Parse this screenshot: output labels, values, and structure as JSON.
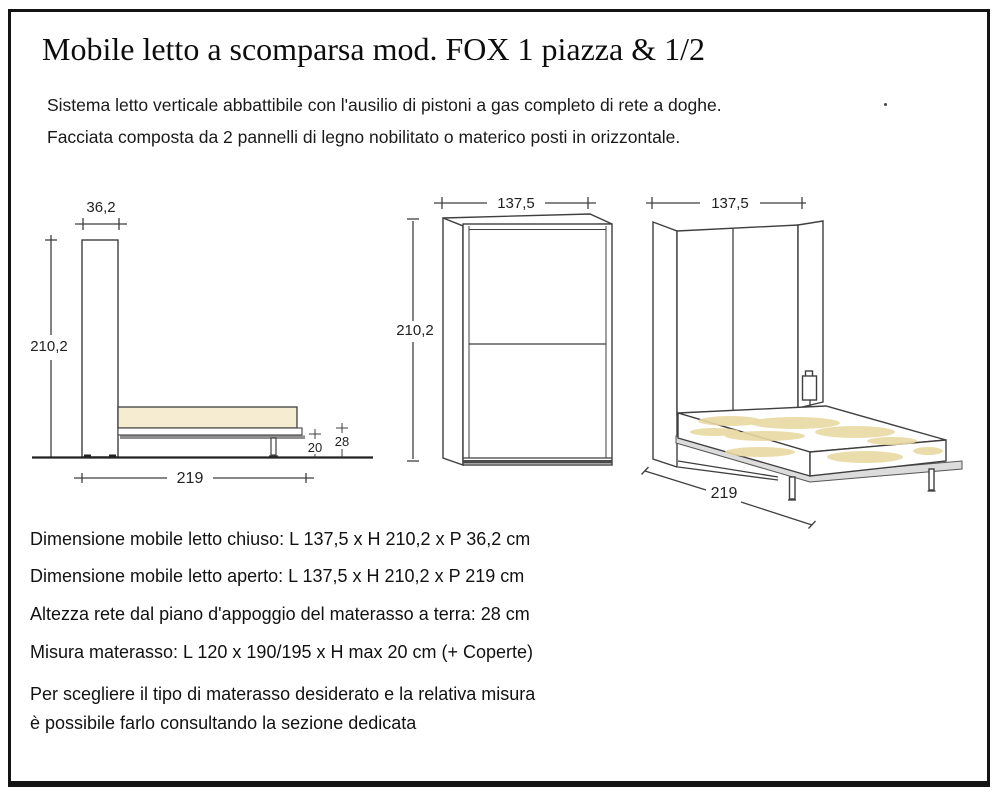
{
  "header": {
    "title": "Mobile letto a scomparsa mod. FOX 1 piazza & 1/2",
    "description_line1": "Sistema letto verticale abbattibile con l'ausilio di pistoni a gas completo di rete a doghe.",
    "description_line2": "Facciata composta da 2 pannelli di legno nobilitato o materico posti in orizzontale."
  },
  "diagrams": {
    "side_view": {
      "depth_closed": "36,2",
      "height": "210,2",
      "depth_open": "219",
      "mattress_thickness": "20",
      "frame_height": "28"
    },
    "front_view": {
      "width": "137,5",
      "height": "210,2"
    },
    "open_view": {
      "width": "137,5",
      "depth_open": "219"
    }
  },
  "specs": {
    "closed": "Dimensione mobile letto chiuso: L 137,5 x H 210,2 x P 36,2 cm",
    "open": "Dimensione mobile letto aperto: L 137,5 x H 210,2 x P 219 cm",
    "slat_height": "Altezza rete dal piano d'appoggio del materasso a terra: 28 cm",
    "mattress": "Misura materasso: L 120 x 190/195 x H max 20 cm (+ Coperte)",
    "note_line1": "Per scegliere il tipo di materasso desiderato e la relativa misura",
    "note_line2": "è possibile farlo consultando la sezione dedicata"
  },
  "colors": {
    "line": "#3f3f3f",
    "border": "#141414",
    "mattress_fill": "#f6ecd2",
    "mattress_texture": "#e9d8a2",
    "platform_dark_gray": "#8f8f8f",
    "platform_light_gray": "#dcdcdc"
  }
}
